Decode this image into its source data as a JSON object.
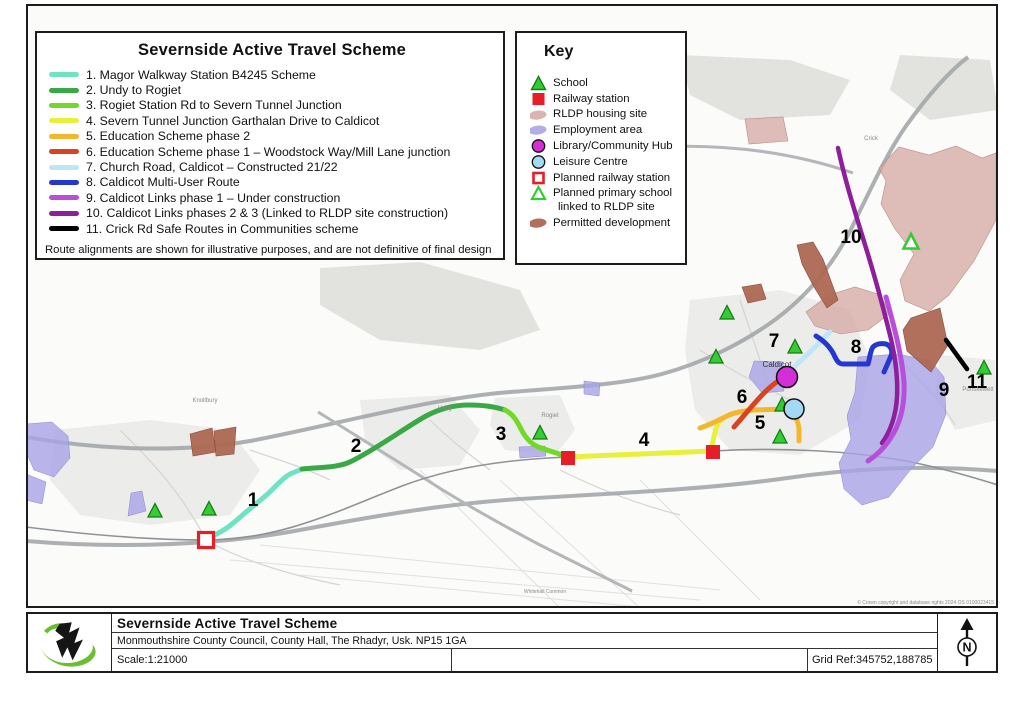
{
  "legend": {
    "title": "Severnside Active Travel Scheme",
    "routes": [
      {
        "label": "1. Magor Walkway Station B4245 Scheme",
        "color": "#6fe3c1"
      },
      {
        "label": "2. Undy to Rogiet",
        "color": "#3aa945"
      },
      {
        "label": "3. Rogiet Station Rd to Severn Tunnel Junction",
        "color": "#72d929"
      },
      {
        "label": "4. Severn Tunnel Junction Garthalan Drive to Caldicot",
        "color": "#e9f03c"
      },
      {
        "label": "5. Education Scheme phase 2",
        "color": "#f2b72d"
      },
      {
        "label": "6. Education Scheme phase 1 –  Woodstock  Way/Mill Lane junction",
        "color": "#d94420"
      },
      {
        "label": "7. Church Road, Caldicot – Constructed 21/22",
        "color": "#bfe6f6"
      },
      {
        "label": "8. Caldicot Multi-User Route",
        "color": "#2438d0"
      },
      {
        "label": "9. Caldicot Links phase 1 – Under construction",
        "color": "#b84fdb"
      },
      {
        "label": "10. Caldicot Links phases 2 & 3 (Linked to RLDP site construction)",
        "color": "#8e1f9b"
      },
      {
        "label": "11. Crick Rd Safe Routes in Communities scheme",
        "color": "#000000"
      }
    ],
    "note": "Route alignments are shown for illustrative purposes, and are not definitive of final design"
  },
  "key": {
    "title": "Key",
    "items": [
      {
        "label": "School",
        "icon": "school"
      },
      {
        "label": "Railway station",
        "icon": "railway-station"
      },
      {
        "label": "RLDP housing site",
        "icon": "rldp-housing-site"
      },
      {
        "label": "Employment area",
        "icon": "employment-area"
      },
      {
        "label": "Library/Community Hub",
        "icon": "library-community-hub"
      },
      {
        "label": "Leisure Centre",
        "icon": "leisure-centre"
      },
      {
        "label": "Planned railway station",
        "icon": "planned-railway-station"
      },
      {
        "label": "Planned primary school",
        "label2": "linked to RLDP site",
        "icon": "planned-primary-school"
      },
      {
        "label": "Permitted development",
        "icon": "permitted-development"
      }
    ]
  },
  "colors": {
    "school_fill": "#33cc33",
    "school_stroke": "#167d16",
    "railway": "#e61e28",
    "rldp_housing": "#d4a8a2",
    "employment": "#a9a4e6",
    "library_hub": "#d42ed8",
    "leisure_centre": "#a3d9f2",
    "planned_railway": "#e61e28",
    "planned_school": "#33cc33",
    "permitted_dev": "#ad6852"
  },
  "map": {
    "route_numbers": [
      {
        "n": "1"
      },
      {
        "n": "2"
      },
      {
        "n": "3"
      },
      {
        "n": "4"
      },
      {
        "n": "5"
      },
      {
        "n": "6"
      },
      {
        "n": "7"
      },
      {
        "n": "8"
      },
      {
        "n": "9"
      },
      {
        "n": "10"
      },
      {
        "n": "11"
      }
    ],
    "towns": [
      {
        "text": "Knollbury"
      },
      {
        "text": "Undy"
      },
      {
        "text": "Rogiet"
      },
      {
        "text": "Caldicot"
      },
      {
        "text": "Crick"
      },
      {
        "text": "Portskewett"
      },
      {
        "text": "Whitehall Common"
      }
    ],
    "copyright": "© Crown copyright and database rights 2024 OS 0100023415"
  },
  "footer": {
    "title": "Severnside Active Travel Scheme",
    "address": "Monmouthshire County Council, County Hall, The Rhadyr, Usk. NP15 1GA",
    "scale": "Scale:1:21000",
    "grid_ref": "Grid Ref:345752,188785",
    "north_label": "N"
  }
}
